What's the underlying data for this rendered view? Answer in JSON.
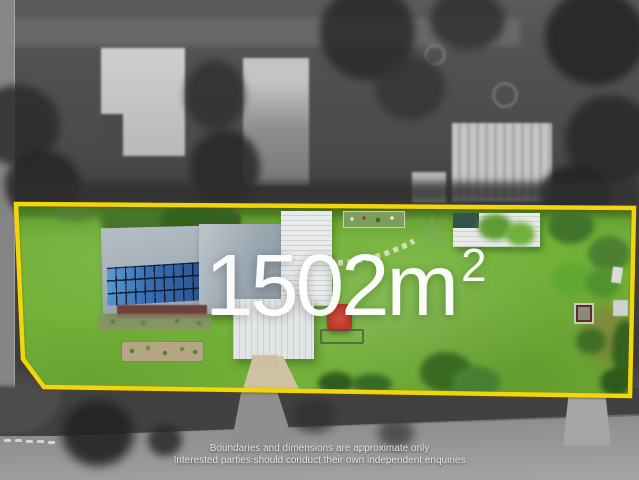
{
  "overlay": {
    "area_value": "1502",
    "area_unit": "m",
    "area_exponent": "2"
  },
  "disclaimer": {
    "line1": "Boundaries and dimensions are approximate only",
    "line2": "Interested parties should conduct their own independent enquiries"
  },
  "boundary": {
    "points": "16,204 634,208 630,396 44,387 23,359"
  },
  "colors": {
    "boundaryYellow": "#f2d50a",
    "grass": "#72b138",
    "grassDark": "#5e9a2d",
    "solarBlue": "#3a6cb0",
    "whiteRoof": "#e8eaeb",
    "drivewayTan": "#cec2a2",
    "maroon": "#6e4038",
    "mulch": "#b5a584",
    "bwBase": "#4f4f4f",
    "textWhite": "#ffffff"
  }
}
